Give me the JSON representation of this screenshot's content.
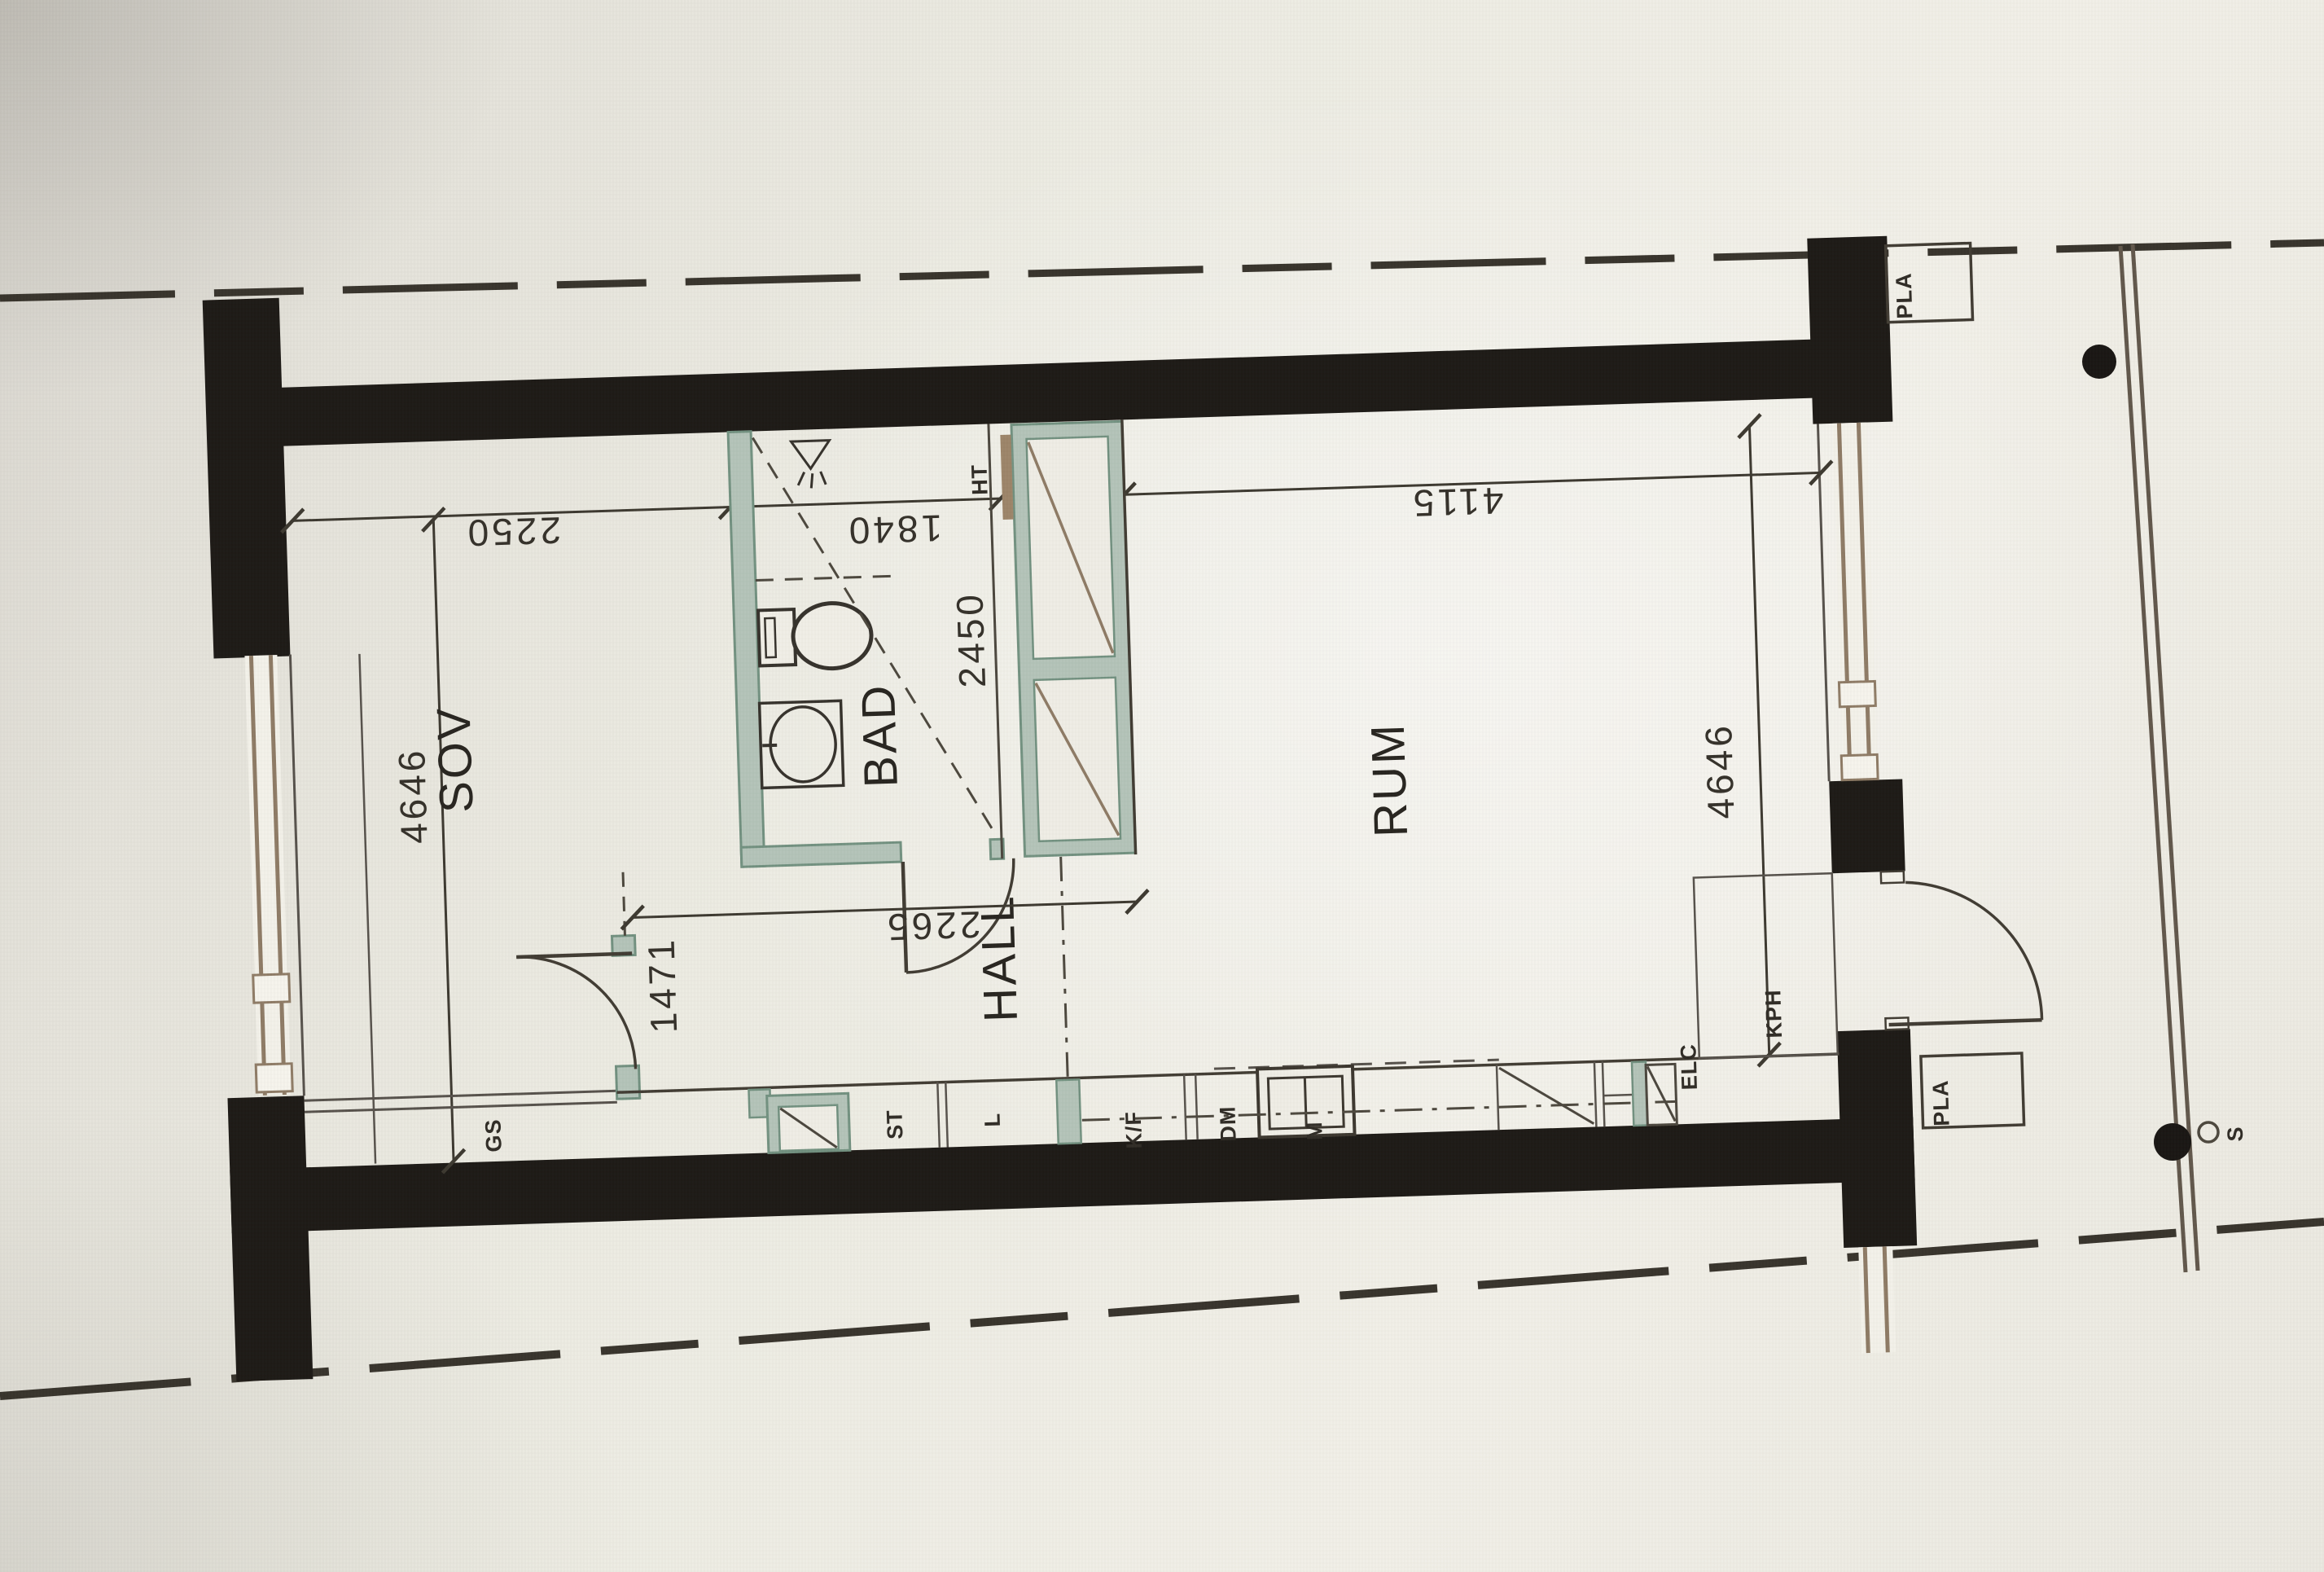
{
  "plan": {
    "type": "apartment-floor-plan-photo",
    "rooms": {
      "sov": {
        "label": "SOV"
      },
      "bad": {
        "label": "BAD"
      },
      "hall": {
        "label": "HALL"
      },
      "rum": {
        "label": "RUM"
      }
    },
    "dimensions_mm": {
      "sov_width": "2250",
      "bad_width": "1840",
      "bad_depth": "2450",
      "rum_width": "4115",
      "depth_left": "4646",
      "depth_right": "4646",
      "hall_opening": "1471",
      "hall_length": "2265"
    },
    "labels": {
      "ht": "HT",
      "gs": "GS",
      "st": "ST",
      "l": "L",
      "kf": "K/F",
      "dm": "DM",
      "m": "M",
      "elc": "ELC",
      "kph": "KPH",
      "pla_top": "PLA",
      "pla_bottom": "PLA",
      "section": "S"
    },
    "colors": {
      "wall_black": "#1b1814",
      "thin_line": "#4b463c",
      "dim_line": "#3b372e",
      "wet_wall_fill": "#b3c3b8",
      "wet_wall_stroke": "#71907f",
      "wood_tan": "#8d7a64",
      "paper": "#edebe3"
    }
  }
}
